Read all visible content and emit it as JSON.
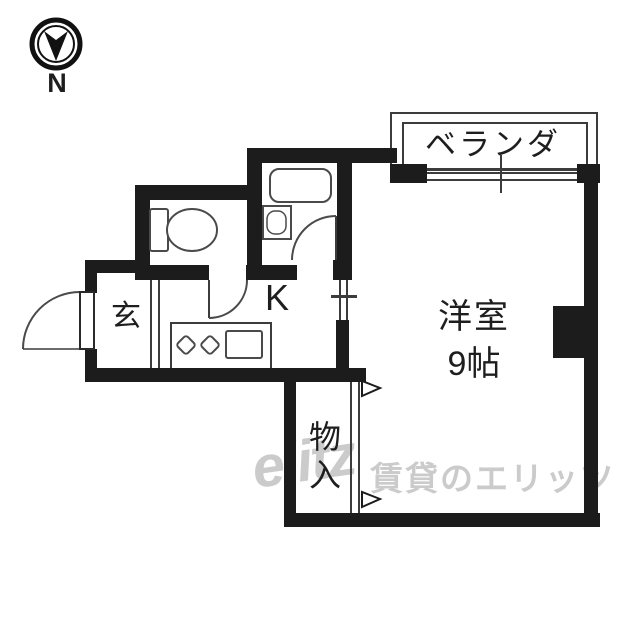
{
  "compass": {
    "north": "N"
  },
  "balcony": {
    "label": "ベランダ"
  },
  "western_room": {
    "name": "洋室",
    "size": "9帖"
  },
  "kitchen": {
    "label": "K"
  },
  "entrance": {
    "label": "玄"
  },
  "closet": {
    "char_top": "物",
    "char_bottom": "入"
  },
  "watermark": {
    "logo": "elitz",
    "brand": "賃貸のエリッツ"
  },
  "icons": [
    "north-compass-icon",
    "toilet-icon",
    "bathtub-icon",
    "washbasin-icon",
    "stove-burner-icon",
    "kitchen-sink-icon",
    "door-swing-arc",
    "sliding-window",
    "closet-direction-triangle"
  ],
  "colors": {
    "wall": "#1c1c1c",
    "thin_line": "#3c3c3c",
    "fixture_line": "#4a4a4a",
    "watermark": "#cbcbcb",
    "text": "#1e1e1e",
    "background": "#ffffff"
  }
}
